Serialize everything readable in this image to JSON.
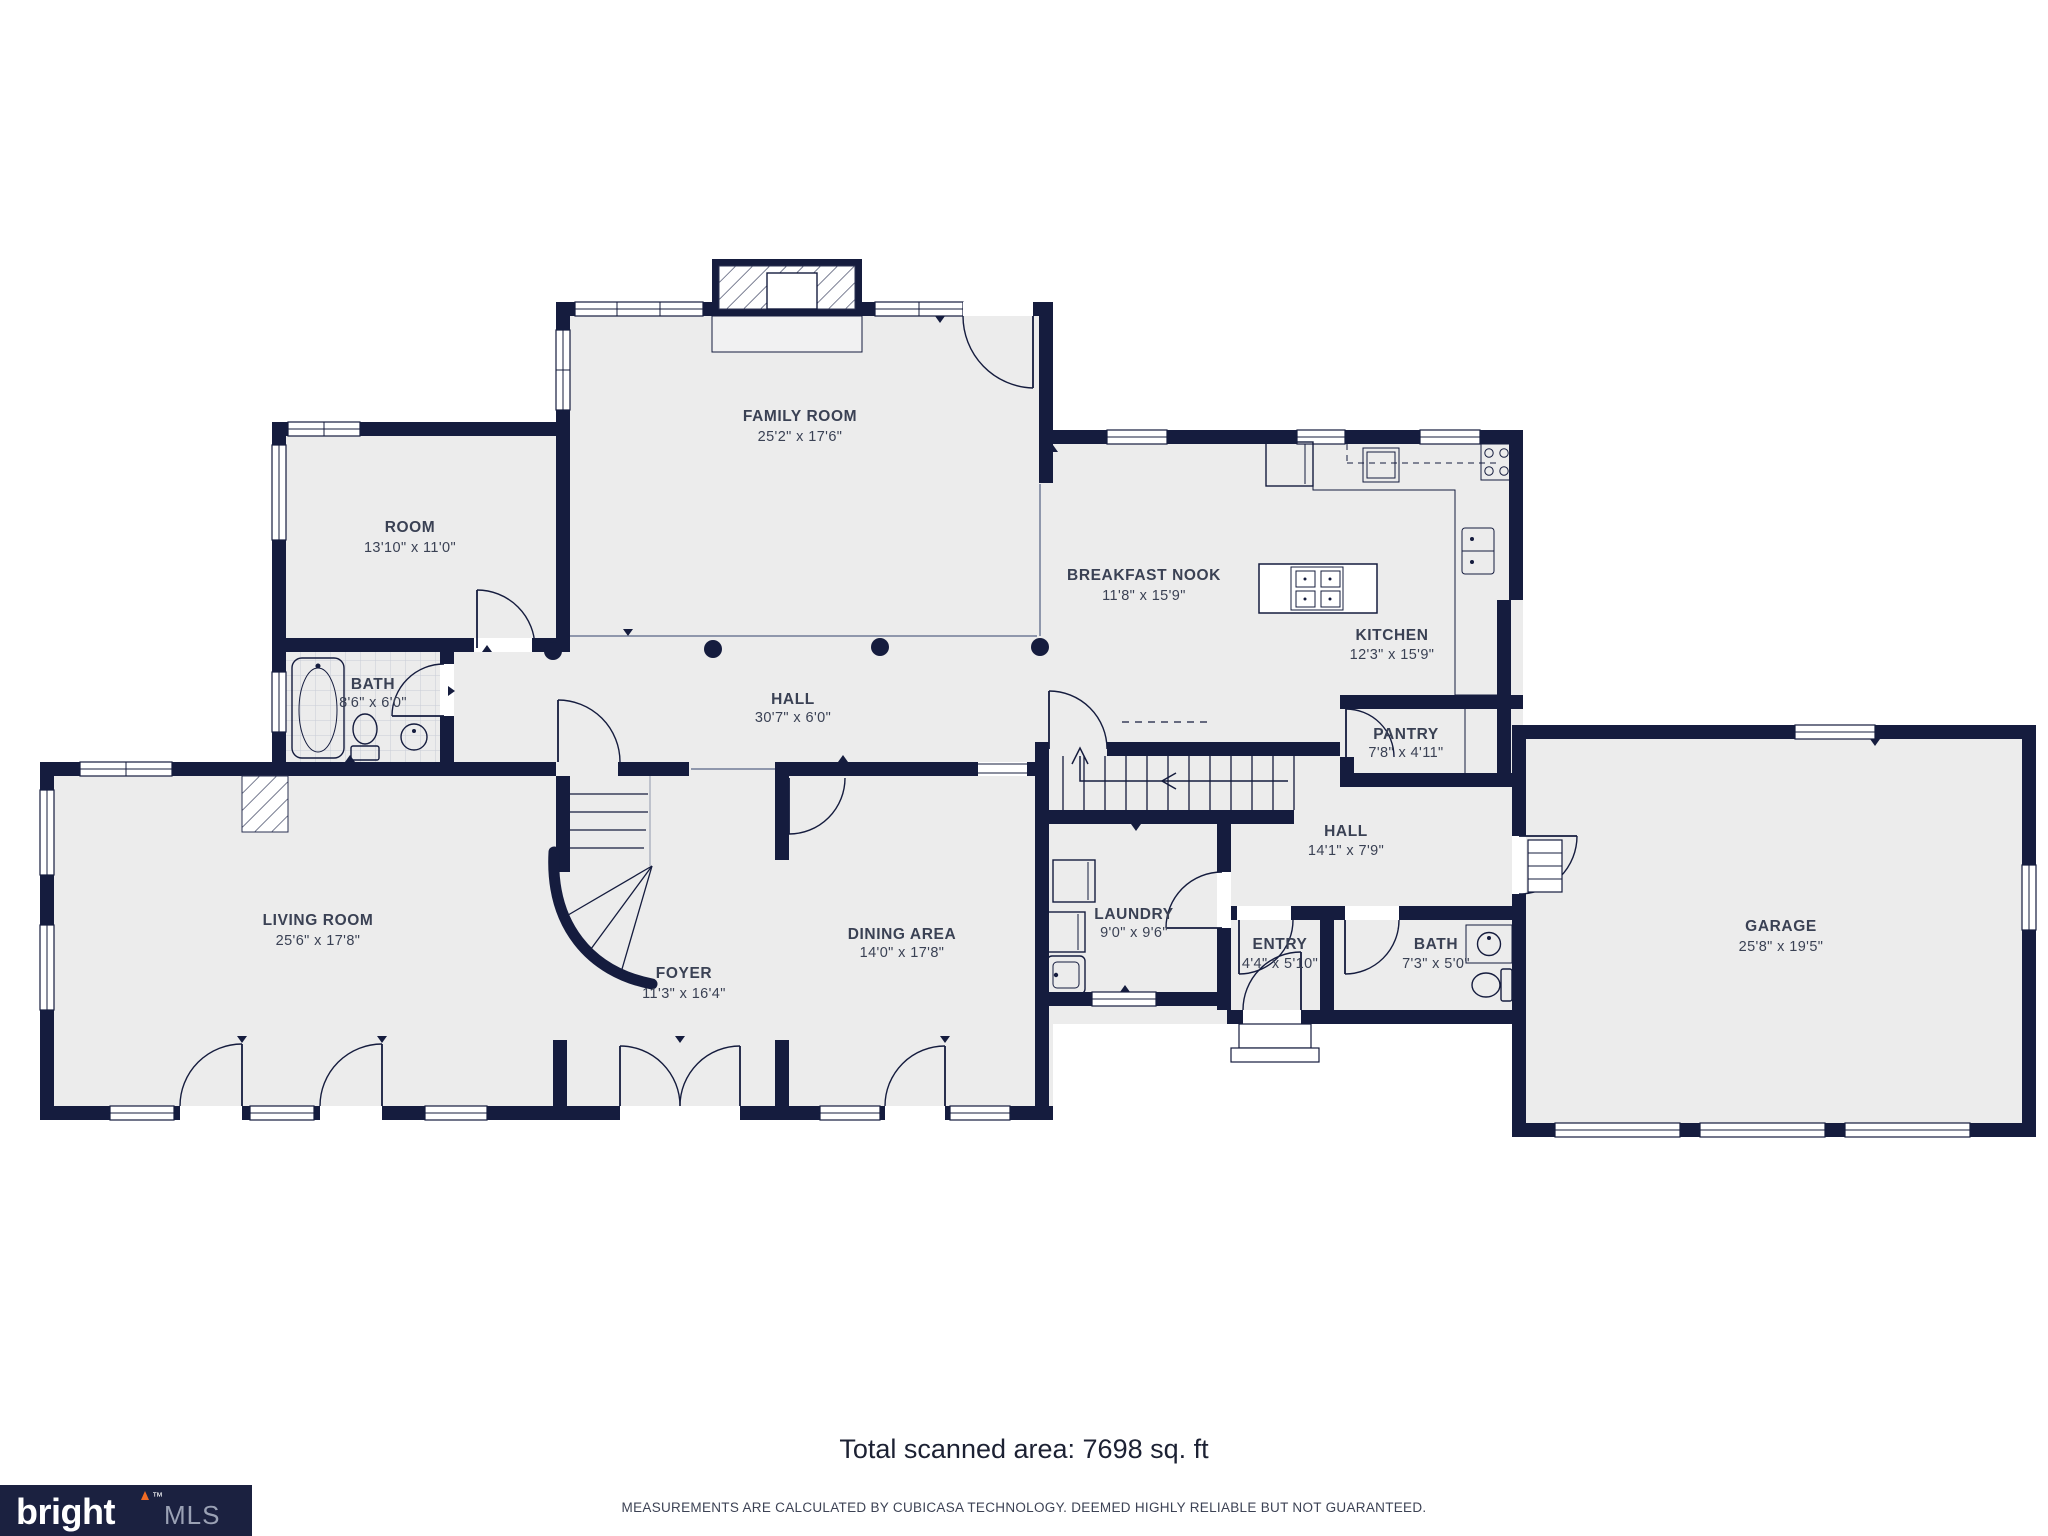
{
  "rooms": [
    {
      "id": "family-room",
      "name": "FAMILY ROOM",
      "dims": "25'2\" x 17'6\""
    },
    {
      "id": "room",
      "name": "ROOM",
      "dims": "13'10\" x 11'0\""
    },
    {
      "id": "bath-main",
      "name": "BATH",
      "dims": "8'6\" x 6'0\""
    },
    {
      "id": "breakfast-nook",
      "name": "BREAKFAST NOOK",
      "dims": "11'8\" x 15'9\""
    },
    {
      "id": "kitchen",
      "name": "KITCHEN",
      "dims": "12'3\" x 15'9\""
    },
    {
      "id": "pantry",
      "name": "PANTRY",
      "dims": "7'8\" x 4'11\""
    },
    {
      "id": "hall-main",
      "name": "HALL",
      "dims": "30'7\" x 6'0\""
    },
    {
      "id": "hall-rear",
      "name": "HALL",
      "dims": "14'1\" x 7'9\""
    },
    {
      "id": "living-room",
      "name": "LIVING ROOM",
      "dims": "25'6\" x 17'8\""
    },
    {
      "id": "foyer",
      "name": "FOYER",
      "dims": "11'3\" x 16'4\""
    },
    {
      "id": "dining-area",
      "name": "DINING AREA",
      "dims": "14'0\" x 17'8\""
    },
    {
      "id": "laundry",
      "name": "LAUNDRY",
      "dims": "9'0\" x 9'6\""
    },
    {
      "id": "entry",
      "name": "ENTRY",
      "dims": "4'4\" x 5'10\""
    },
    {
      "id": "bath-hall",
      "name": "BATH",
      "dims": "7'3\" x 5'0\""
    },
    {
      "id": "garage",
      "name": "GARAGE",
      "dims": "25'8\" x 19'5\""
    }
  ],
  "footer": {
    "total_area": "Total scanned area: 7698 sq. ft",
    "disclaimer": "MEASUREMENTS ARE CALCULATED BY CUBICASA TECHNOLOGY. DEEMED HIGHLY RELIABLE BUT NOT GUARANTEED."
  },
  "logo": {
    "brand": "bright",
    "tm": "™",
    "suffix": "MLS"
  },
  "colors": {
    "wall": "#151c3e",
    "floor": "#ececec",
    "label": "#3a4154",
    "accent": "#f26b24",
    "logo_bg": "#1b2140",
    "text_dark": "#1c2133",
    "muted": "#9aa1b4"
  }
}
